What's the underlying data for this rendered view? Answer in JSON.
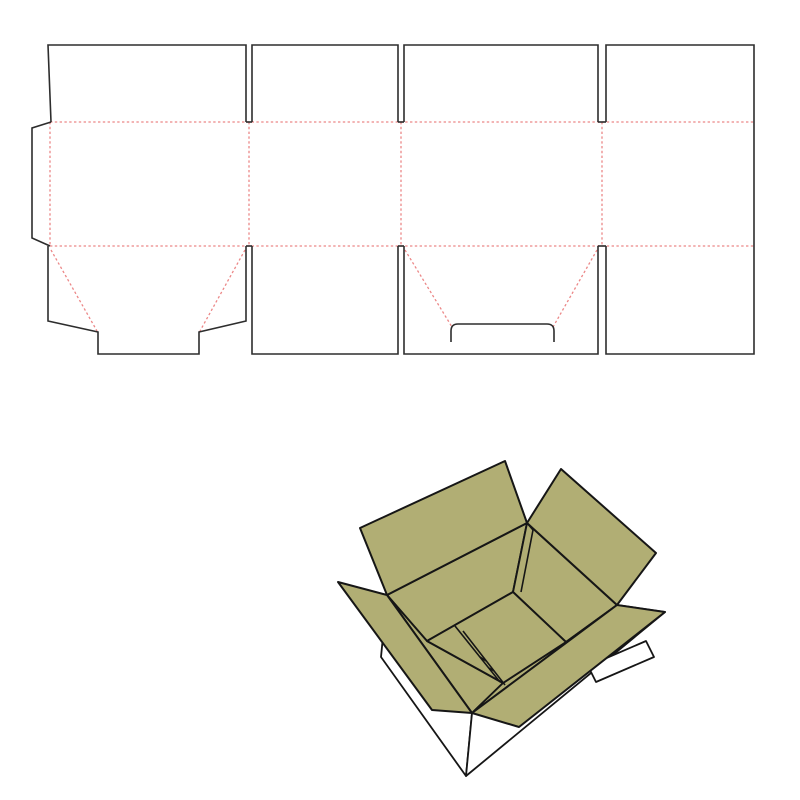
{
  "canvas": {
    "width": 800,
    "height": 800
  },
  "colors": {
    "background": "#ffffff",
    "cut_line": "#2d2d2d",
    "fold_line": "#ec8787",
    "board_fill": "#b1ae74",
    "board_outline": "#161616",
    "white_fill": "#ffffff"
  },
  "dieline": {
    "cut_paths": [
      {
        "name": "top-flap-1-cut",
        "d": "M 51 122 L 48 45 L 246 45 L 246 122"
      },
      {
        "name": "top-slit-1-bottom",
        "d": "M 246 122 L 252 122"
      },
      {
        "name": "top-flap-2-cut",
        "d": "M 252 122 L 252 45 L 398 45 L 398 122"
      },
      {
        "name": "top-slit-2-bottom",
        "d": "M 398 122 L 404 122"
      },
      {
        "name": "top-flap-3-cut",
        "d": "M 404 122 L 404 45 L 598 45 L 598 122"
      },
      {
        "name": "top-slit-3-bottom",
        "d": "M 598 122 L 606 122"
      },
      {
        "name": "panel-4-outline-cut",
        "d": "M 606 122 L 606 45 L 754 45 L 754 354 L 606 354 L 606 246"
      },
      {
        "name": "glue-flap-cut",
        "d": "M 51 122 L 32 128 L 32 238 L 50 246"
      },
      {
        "name": "bottom-flap-1-cut",
        "d": "M 48 246 L 48 321 L 98 332 L 98 354 L 199 354 L 199 332 L 246 321 L 246 246"
      },
      {
        "name": "bottom-slit-1-top",
        "d": "M 246 246 L 252 246"
      },
      {
        "name": "bottom-flap-2-cut",
        "d": "M 252 246 L 252 354 L 398 354 L 398 246"
      },
      {
        "name": "bottom-slit-2-top",
        "d": "M 398 246 L 404 246"
      },
      {
        "name": "bottom-flap-3-cut",
        "d": "M 404 246 L 404 354 L 598 354 L 598 246"
      },
      {
        "name": "bottom-slit-3-top",
        "d": "M 598 246 L 606 246"
      },
      {
        "name": "handle-slot-cut",
        "d": "M 451 342 L 451 331 Q 451 324 458 324 L 547 324 Q 554 324 554 331 L 554 342"
      }
    ],
    "fold_lines": [
      {
        "name": "fold-top-horizontal",
        "d": "M 50 122 L 754 122"
      },
      {
        "name": "fold-bottom-horizontal",
        "d": "M 50 246 L 754 246"
      },
      {
        "name": "fold-glue-flap",
        "d": "M 50 122 L 50 246"
      },
      {
        "name": "fold-panel-1-2",
        "d": "M 249 122 L 249 246"
      },
      {
        "name": "fold-panel-2-3",
        "d": "M 401 122 L 401 246"
      },
      {
        "name": "fold-panel-3-4",
        "d": "M 602 122 L 602 246"
      },
      {
        "name": "fold-diagonal-flap1-left",
        "d": "M 51 250 L 97 331"
      },
      {
        "name": "fold-diagonal-flap1-right",
        "d": "M 245 250 L 200 331"
      },
      {
        "name": "fold-diagonal-flap3-left",
        "d": "M 405 250 L 452 327"
      },
      {
        "name": "fold-diagonal-flap3-right",
        "d": "M 597 250 L 553 327"
      }
    ]
  },
  "box3d": {
    "white_shapes": [
      {
        "name": "outer-wall-near-left",
        "points": "387,595 472,713 466,776 381,657"
      },
      {
        "name": "outer-wall-near-right",
        "points": "472,713 617,605 665,612 466,776"
      },
      {
        "name": "bottom-flap-edge-right",
        "points": "588,666 596,682 654,657 646,641"
      }
    ],
    "board_shapes": [
      {
        "name": "interior-wall-back-left",
        "points": "387,595 527,523 513,592 427,641"
      },
      {
        "name": "interior-wall-back-right",
        "points": "527,523 617,605 566,642 513,592"
      },
      {
        "name": "interior-wall-near-left",
        "points": "387,595 427,641 503,683 472,713"
      },
      {
        "name": "interior-wall-near-right",
        "points": "472,713 503,683 566,642 617,605"
      },
      {
        "name": "box-floor",
        "points": "427,641 513,592 566,642 503,683"
      }
    ],
    "detail_paths": [
      {
        "name": "glue-seam-line",
        "d": "M 527 523 L 533 530 L 521 592"
      },
      {
        "name": "floor-strip-line-1",
        "d": "M 455 626 L 500 682"
      },
      {
        "name": "floor-strip-line-2",
        "d": "M 463 631 L 505 685"
      },
      {
        "name": "floor-strip-tick-1",
        "d": "M 480 657 L 486 661"
      },
      {
        "name": "floor-strip-tick-2",
        "d": "M 489 668 L 494 671"
      }
    ],
    "flap_shapes": [
      {
        "name": "open-flap-back-left",
        "points": "387,595 360,528 505,461 527,523"
      },
      {
        "name": "open-flap-back-right",
        "points": "527,523 561,469 656,553 617,605"
      },
      {
        "name": "open-flap-left",
        "points": "387,595 338,582 432,710 472,713"
      },
      {
        "name": "open-flap-front-right",
        "points": "472,713 519,727 665,612 617,605"
      }
    ]
  }
}
